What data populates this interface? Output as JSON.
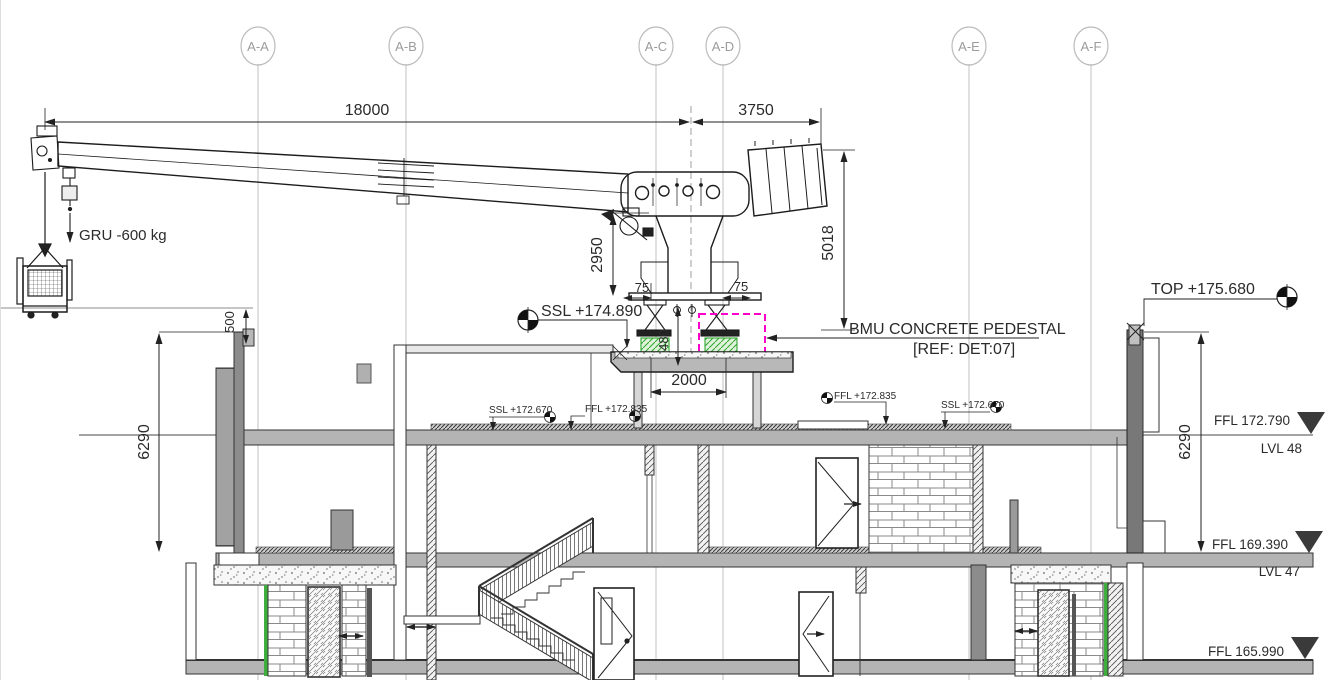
{
  "drawing": {
    "type": "building-section-with-bmu-crane",
    "grid": {
      "labels": [
        "A-A",
        "A-B",
        "A-C",
        "A-D",
        "A-E",
        "A-F"
      ]
    },
    "dimensions": {
      "jib_reach": "18000",
      "counter_jib": "3750",
      "mast_height": "2950",
      "counterweight_height": "5018",
      "parapet_offset": "500",
      "left_storey_height": "6290",
      "right_storey_height": "6290",
      "pedestal_offset_left": "75",
      "pedestal_offset_right": "75",
      "pedestal_height": "480",
      "pedestal_spacing": "2000"
    },
    "levels": {
      "top_parapet": "TOP +175.680",
      "ssl_pedestal": "SSL +174.890",
      "ffl_48": "FFL 172.790",
      "lvl_48": "LVL 48",
      "ssl_48_left": "SSL +172.670",
      "ffl_48_left": "FFL +172.835",
      "ffl_48_right": "FFL +172.835",
      "ssl_48_right": "SSL +172.670",
      "ffl_47": "FFL 169.390",
      "lvl_47": "LVL 47",
      "ffl_46": "FFL 165.990"
    },
    "annotations": {
      "crane_load": "GRU -600 kg",
      "pedestal_note_line1": "BMU CONCRETE PEDESTAL",
      "pedestal_note_line2": "[REF: DET:07]"
    },
    "colors": {
      "highlight_magenta": "#FF00CC",
      "pedestal_green": "#2FA52F",
      "slab_grey": "#B4B4B4",
      "wall_dark_grey": "#787878",
      "grid_grey": "#CCCCCC"
    }
  }
}
